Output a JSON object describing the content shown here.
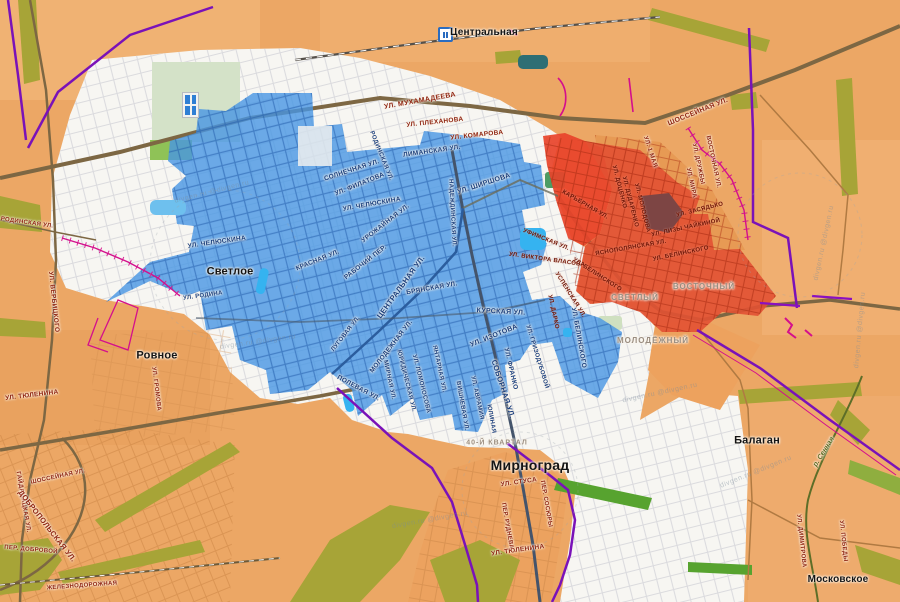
{
  "colors": {
    "bg_orange": "#eca765",
    "urban_white": "#f7f6f2",
    "blue_zone": "#4796e4",
    "red_zone": "#e25133",
    "red_zone_bright": "#e8432a",
    "maroon_patch": "#7d4544",
    "purple_boundary": "#7a12b8",
    "magenta_line": "#d40f8c",
    "olive_green": "#a7a437",
    "town_text": "#141414",
    "blue_street_text": "#1b3f7d",
    "red_street_text": "#8f2410"
  },
  "station": {
    "label": "Центральная"
  },
  "labels": [
    {
      "t": "Лиманская ул.",
      "x": 432,
      "y": 152,
      "r": -8,
      "s": 6.5,
      "c": "b"
    },
    {
      "t": "Родинская ул.",
      "x": 381,
      "y": 156,
      "r": 68,
      "s": 6,
      "c": "b"
    },
    {
      "t": "Солнечная ул.",
      "x": 352,
      "y": 171,
      "r": -18,
      "s": 6.5,
      "c": "b"
    },
    {
      "t": "ул. Филатова",
      "x": 360,
      "y": 185,
      "r": -22,
      "s": 6.5,
      "c": "b"
    },
    {
      "t": "ул. Ширшова",
      "x": 484,
      "y": 184,
      "r": -18,
      "s": 7,
      "c": "b"
    },
    {
      "t": "Надеждинская ул.",
      "x": 452,
      "y": 213,
      "r": 87,
      "s": 6,
      "c": "b"
    },
    {
      "t": "ул. Челюскина",
      "x": 372,
      "y": 205,
      "r": -10,
      "s": 6.5,
      "c": "b"
    },
    {
      "t": "Урожайная ул.",
      "x": 386,
      "y": 224,
      "r": -38,
      "s": 6.5,
      "c": "b"
    },
    {
      "t": "ул. Челюскина",
      "x": 217,
      "y": 243,
      "r": -8,
      "s": 6.5,
      "c": "b"
    },
    {
      "t": "Красная ул.",
      "x": 318,
      "y": 261,
      "r": -22,
      "s": 6.5,
      "c": "b"
    },
    {
      "t": "Рабочий пер.",
      "x": 366,
      "y": 263,
      "r": -38,
      "s": 6.5,
      "c": "b"
    },
    {
      "t": "ул. Родина",
      "x": 203,
      "y": 296,
      "r": -8,
      "s": 6,
      "c": "b"
    },
    {
      "t": "Центральная ул.",
      "x": 401,
      "y": 287,
      "r": -54,
      "s": 7.5,
      "c": "b"
    },
    {
      "t": "Брянская ул.",
      "x": 432,
      "y": 289,
      "r": -10,
      "s": 6.5,
      "c": "b"
    },
    {
      "t": "Курская ул.",
      "x": 501,
      "y": 312,
      "r": 3,
      "s": 7,
      "c": "b"
    },
    {
      "t": "ул. Изотова",
      "x": 494,
      "y": 336,
      "r": -22,
      "s": 7,
      "c": "b"
    },
    {
      "t": "ул. Гризодубовой",
      "x": 537,
      "y": 357,
      "r": 73,
      "s": 6,
      "c": "b"
    },
    {
      "t": "ул. Франко",
      "x": 510,
      "y": 369,
      "r": 77,
      "s": 6.5,
      "c": "b"
    },
    {
      "t": "ул. Белинского",
      "x": 578,
      "y": 338,
      "r": 80,
      "s": 6.5,
      "c": "b"
    },
    {
      "t": "Молодежная ул.",
      "x": 392,
      "y": 347,
      "r": -52,
      "s": 6.5,
      "c": "b"
    },
    {
      "t": "Мирная ул.",
      "x": 389,
      "y": 380,
      "r": 78,
      "s": 6,
      "c": "b"
    },
    {
      "t": "Юридическая ул.",
      "x": 406,
      "y": 381,
      "r": 76,
      "s": 6,
      "c": "b"
    },
    {
      "t": "ул. Ломоносова",
      "x": 421,
      "y": 384,
      "r": 76,
      "s": 6,
      "c": "b"
    },
    {
      "t": "Янтарная ул.",
      "x": 439,
      "y": 369,
      "r": 78,
      "s": 6,
      "c": "b"
    },
    {
      "t": "Вишневая ул.",
      "x": 462,
      "y": 406,
      "r": 80,
      "s": 6,
      "c": "b"
    },
    {
      "t": "ул. Аврамия",
      "x": 477,
      "y": 398,
      "r": 78,
      "s": 6,
      "c": "b"
    },
    {
      "t": "Юлиная",
      "x": 491,
      "y": 419,
      "r": 80,
      "s": 6,
      "c": "b"
    },
    {
      "t": "Соборная ул.",
      "x": 503,
      "y": 389,
      "r": 72,
      "s": 7.5,
      "c": "b"
    },
    {
      "t": "Полевая ул.",
      "x": 358,
      "y": 389,
      "r": 28,
      "s": 6.5,
      "c": "b"
    },
    {
      "t": "Луговая ул.",
      "x": 346,
      "y": 334,
      "r": -52,
      "s": 6,
      "c": "b"
    },
    {
      "t": "ул. Мухамадеева",
      "x": 420,
      "y": 101,
      "r": -10,
      "s": 7,
      "c": "r"
    },
    {
      "t": "ул. Плеханова",
      "x": 435,
      "y": 123,
      "r": -6,
      "s": 6.5,
      "c": "r"
    },
    {
      "t": "ул. Комарова",
      "x": 477,
      "y": 136,
      "r": -6,
      "s": 6.5,
      "c": "r"
    },
    {
      "t": "Шоссейная ул.",
      "x": 698,
      "y": 112,
      "r": -22,
      "s": 7,
      "c": "r"
    },
    {
      "t": "Восточная ул.",
      "x": 713,
      "y": 162,
      "r": 78,
      "s": 6,
      "c": "r"
    },
    {
      "t": "ул. Дружбы",
      "x": 698,
      "y": 164,
      "r": 78,
      "s": 6,
      "c": "r"
    },
    {
      "t": "ул. Мира",
      "x": 691,
      "y": 183,
      "r": 78,
      "s": 6,
      "c": "r"
    },
    {
      "t": "ул. 1 Мая",
      "x": 650,
      "y": 152,
      "r": 72,
      "s": 6,
      "c": "r"
    },
    {
      "t": "ул. Тюленина",
      "x": 32,
      "y": 396,
      "r": -7,
      "s": 6.5,
      "c": "r"
    },
    {
      "t": "ул. Громова",
      "x": 156,
      "y": 389,
      "r": 83,
      "s": 6,
      "c": "r"
    },
    {
      "t": "Родинская ул.",
      "x": 27,
      "y": 223,
      "r": 8,
      "s": 6,
      "c": "r"
    },
    {
      "t": "ул. Вербицкого",
      "x": 53,
      "y": 302,
      "r": 84,
      "s": 6.5,
      "c": "r"
    },
    {
      "t": "Шоссейная ул.",
      "x": 58,
      "y": 477,
      "r": -12,
      "s": 6,
      "c": "r"
    },
    {
      "t": "Гайдамацкая ул.",
      "x": 23,
      "y": 502,
      "r": 80,
      "s": 6,
      "c": "r"
    },
    {
      "t": "Добропольская ул.",
      "x": 47,
      "y": 526,
      "r": 52,
      "s": 7.5,
      "c": "r"
    },
    {
      "t": "пер. Добровой",
      "x": 31,
      "y": 550,
      "r": 5,
      "s": 6,
      "c": "r"
    },
    {
      "t": "Железнодорожная",
      "x": 82,
      "y": 586,
      "r": -4,
      "s": 6,
      "c": "r"
    },
    {
      "t": "ул. Стуса",
      "x": 519,
      "y": 483,
      "r": -8,
      "s": 6.5,
      "c": "r"
    },
    {
      "t": "пер. Сосюры",
      "x": 546,
      "y": 504,
      "r": 80,
      "s": 6,
      "c": "r"
    },
    {
      "t": "пер. Руднева",
      "x": 507,
      "y": 526,
      "r": 80,
      "s": 6,
      "c": "r"
    },
    {
      "t": "ул. Тюленина",
      "x": 518,
      "y": 551,
      "r": -8,
      "s": 6.5,
      "c": "r"
    },
    {
      "t": "ул. Димитрова",
      "x": 801,
      "y": 541,
      "r": 84,
      "s": 6,
      "c": "r"
    },
    {
      "t": "ул. Победы",
      "x": 843,
      "y": 541,
      "r": 84,
      "s": 6,
      "c": "r"
    },
    {
      "t": "ул. Доценко",
      "x": 619,
      "y": 187,
      "r": 76,
      "s": 6,
      "c": "d"
    },
    {
      "t": "ул. Дударенко",
      "x": 630,
      "y": 202,
      "r": 76,
      "s": 6,
      "c": "d"
    },
    {
      "t": "ул. Молодова",
      "x": 642,
      "y": 208,
      "r": 76,
      "s": 6,
      "c": "d"
    },
    {
      "t": "ул. Засядько",
      "x": 700,
      "y": 210,
      "r": -14,
      "s": 6,
      "c": "d"
    },
    {
      "t": "ул. Лизы Чайкиной",
      "x": 686,
      "y": 228,
      "r": -12,
      "s": 6,
      "c": "d"
    },
    {
      "t": "Яснополянская ул.",
      "x": 631,
      "y": 248,
      "r": -10,
      "s": 6,
      "c": "d"
    },
    {
      "t": "ул. Белинского",
      "x": 681,
      "y": 254,
      "r": -12,
      "s": 6,
      "c": "d"
    },
    {
      "t": "ул. Белинского",
      "x": 597,
      "y": 275,
      "r": 33,
      "s": 6,
      "c": "d"
    },
    {
      "t": "Карьерная ул.",
      "x": 585,
      "y": 205,
      "r": 30,
      "s": 6,
      "c": "d"
    },
    {
      "t": "Уфимская ул.",
      "x": 546,
      "y": 240,
      "r": 22,
      "s": 6,
      "c": "d"
    },
    {
      "t": "ул. Виктора Власова",
      "x": 547,
      "y": 260,
      "r": 8,
      "s": 6,
      "c": "d"
    },
    {
      "t": "Успенская ул.",
      "x": 570,
      "y": 295,
      "r": 58,
      "s": 6,
      "c": "d"
    },
    {
      "t": "ул. Дарко",
      "x": 553,
      "y": 312,
      "r": 78,
      "s": 6,
      "c": "d"
    },
    {
      "t": "Светлое",
      "x": 230,
      "y": 272,
      "r": 0,
      "s": 11,
      "c": "t"
    },
    {
      "t": "Ровное",
      "x": 157,
      "y": 356,
      "r": 0,
      "s": 11,
      "c": "t"
    },
    {
      "t": "Мирноград",
      "x": 530,
      "y": 465,
      "r": 0,
      "s": 14,
      "c": "t"
    },
    {
      "t": "Балаган",
      "x": 757,
      "y": 441,
      "r": 0,
      "s": 11,
      "c": "t"
    },
    {
      "t": "Московское",
      "x": 838,
      "y": 580,
      "r": 0,
      "s": 10,
      "c": "t"
    },
    {
      "t": "Светлый",
      "x": 635,
      "y": 298,
      "r": 0,
      "s": 8,
      "c": "g"
    },
    {
      "t": "Молодёжный",
      "x": 653,
      "y": 341,
      "r": 0,
      "s": 8,
      "c": "g"
    },
    {
      "t": "Восточный",
      "x": 704,
      "y": 287,
      "r": 0,
      "s": 8,
      "c": "g"
    },
    {
      "t": "40-й квартал",
      "x": 497,
      "y": 443,
      "r": 0,
      "s": 7,
      "c": "g"
    },
    {
      "t": "р. Сенная",
      "x": 824,
      "y": 452,
      "r": -58,
      "s": 7,
      "c": "v"
    },
    {
      "t": "divgen.ru @divgen.ru",
      "x": 212,
      "y": 192,
      "r": -14,
      "s": 7,
      "c": "w"
    },
    {
      "t": "divgen.ru @divgen.ru",
      "x": 258,
      "y": 342,
      "r": -8,
      "s": 7,
      "c": "w"
    },
    {
      "t": "divgen.ru @divgen.ru",
      "x": 660,
      "y": 393,
      "r": -12,
      "s": 7,
      "c": "w"
    },
    {
      "t": "divgen.ru @divgen.ru",
      "x": 824,
      "y": 243,
      "r": -78,
      "s": 7,
      "c": "w"
    },
    {
      "t": "divgen.ru @divgen.ru",
      "x": 756,
      "y": 472,
      "r": -22,
      "s": 7,
      "c": "w"
    },
    {
      "t": "divgen.ru @divgen.ru",
      "x": 860,
      "y": 330,
      "r": -85,
      "s": 7,
      "c": "w"
    },
    {
      "t": "divgen.ru @divgen.ru",
      "x": 430,
      "y": 520,
      "r": -10,
      "s": 7,
      "c": "w"
    }
  ]
}
